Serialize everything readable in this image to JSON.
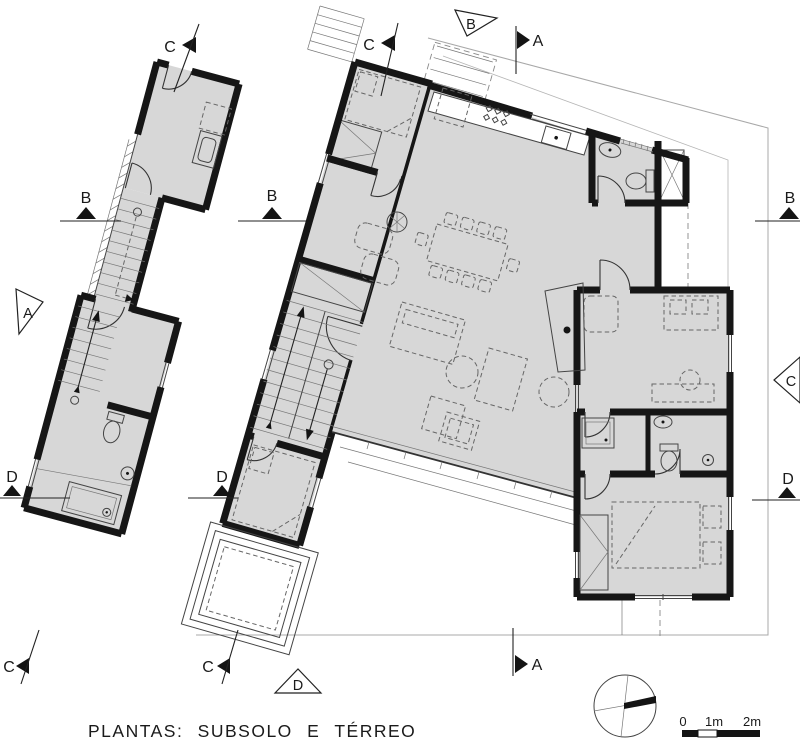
{
  "drawing": {
    "title": "PLANTAS: SUBSOLO E TÉRREO",
    "scale_bar": {
      "t0": "0",
      "t1": "1m",
      "t2": "2m"
    },
    "markers": {
      "c_top_left": "C",
      "c_top_mid": "C",
      "b_top": "B",
      "a_top": "A",
      "b_left": "B",
      "b_mid": "B",
      "b_right": "B",
      "a_left": "A",
      "c_right": "C",
      "d_left": "D",
      "d_mid": "D",
      "d_right": "D",
      "c_bottom_left": "C",
      "c_bottom_mid": "C",
      "d_bottom": "D",
      "a_bottom": "A"
    },
    "colors": {
      "wall": "#161616",
      "room_fill": "#d7d7d7",
      "thin_line": "#444444",
      "boundary": "#a8a8a8",
      "background": "#ffffff"
    }
  }
}
